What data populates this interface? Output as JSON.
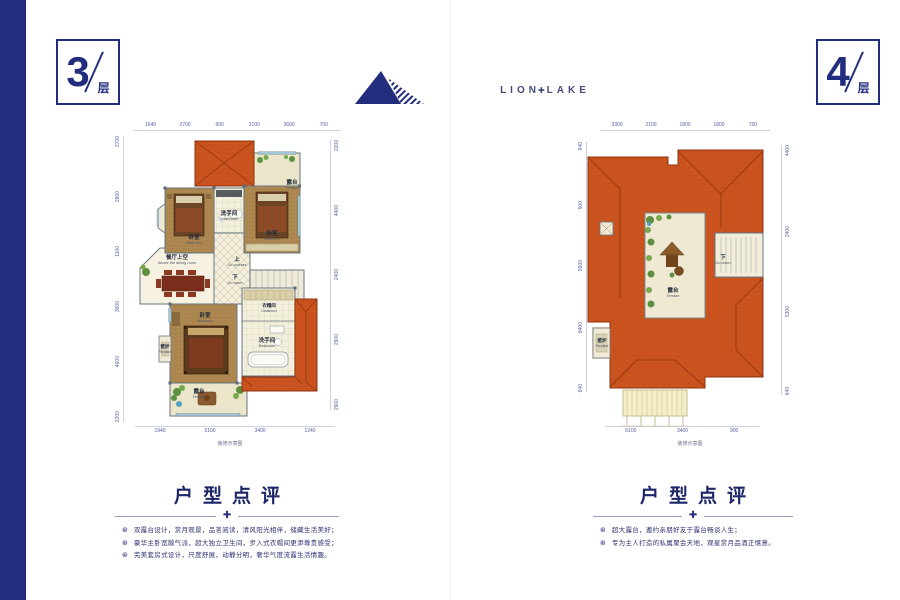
{
  "floor_badges": [
    {
      "number": "3",
      "unit": "层"
    },
    {
      "number": "4",
      "unit": "层"
    }
  ],
  "brand": {
    "name_left": "LION",
    "cross": "✚",
    "name_right": "LAKE"
  },
  "plans": [
    {
      "floor": "3",
      "dims_top": [
        "1640",
        "2700",
        "600",
        "2100",
        "3600",
        "700"
      ],
      "dims_left": [
        "2700",
        "2800",
        "1100",
        "3600",
        "4600",
        "2200"
      ],
      "dims_right": [
        "2200",
        "4400",
        "2400",
        "2900",
        "2900"
      ],
      "dims_bottom": [
        "1940",
        "5100",
        "3400",
        "1240"
      ],
      "caption": "装修示意图",
      "rooms": {
        "terrace_top": {
          "cn": "露台",
          "en": "Terrace"
        },
        "bedroom_right": {
          "cn": "卧室",
          "en": "Bedroom"
        },
        "bedroom_left": {
          "cn": "卧室",
          "en": "Bedroom"
        },
        "washroom": {
          "cn": "洗手间",
          "en": "Washroom"
        },
        "up": {
          "cn": "上",
          "en": "Go upstairs"
        },
        "down": {
          "cn": "下",
          "en": "Go down"
        },
        "dining_void": {
          "cn": "餐厅上空",
          "en": "Above the dining room"
        },
        "master_bedroom": {
          "cn": "卧室",
          "en": "Bedroom"
        },
        "fireplace": {
          "cn": "壁炉",
          "en": "Fireplace"
        },
        "terrace_bottom": {
          "cn": "露台",
          "en": "Terrace"
        },
        "washroom_lower": {
          "cn": "洗手间",
          "en": "Restroom"
        },
        "cloakroom": {
          "cn": "衣帽间",
          "en": "Cloakroom"
        }
      }
    },
    {
      "floor": "4",
      "dims_top": [
        "3300",
        "2100",
        "1800",
        "1800",
        "700"
      ],
      "dims_left": [
        "640",
        "500",
        "5900",
        "8400",
        "640"
      ],
      "dims_right": [
        "4400",
        "2400",
        "5300",
        "640"
      ],
      "dims_bottom": [
        "5100",
        "3400",
        "900"
      ],
      "caption": "装修示意图",
      "rooms": {
        "terrace": {
          "cn": "露台",
          "en": "Terrace"
        },
        "down": {
          "cn": "下",
          "en": "Go down"
        },
        "fireplace": {
          "cn": "壁炉",
          "en": "Fireplace"
        }
      }
    }
  ],
  "reviews": [
    {
      "title": "户型点评",
      "ornament_glyph": "✚",
      "bullet_glyph": "⊛",
      "items": [
        "双露台设计，赏月观景，品茗阅读，清风阳光相伴，储藏生活美好；",
        "豪华主卧宽敞气派，超大独立卫生间，步入式衣帽间更添尊贵感受；",
        "完美套房式设计，尺度舒展，动静分明，奢华气度流露生活情趣。"
      ]
    },
    {
      "title": "户型点评",
      "ornament_glyph": "✚",
      "bullet_glyph": "⊛",
      "items": [
        "超大露台，邀约亲朋好友于露台畅谈人生；",
        "专为主人打造的私属聚会天地，观星赏月品酒正惬意。"
      ]
    }
  ],
  "colors": {
    "accent_navy": "#232d7e",
    "roof_orange": "#cd5520",
    "wood_floor": "#b08a52",
    "cream_floor": "#f3eedb",
    "plant_green": "#5d9140",
    "window_blue": "#a3c6d6",
    "dim_text": "#5560a0"
  }
}
